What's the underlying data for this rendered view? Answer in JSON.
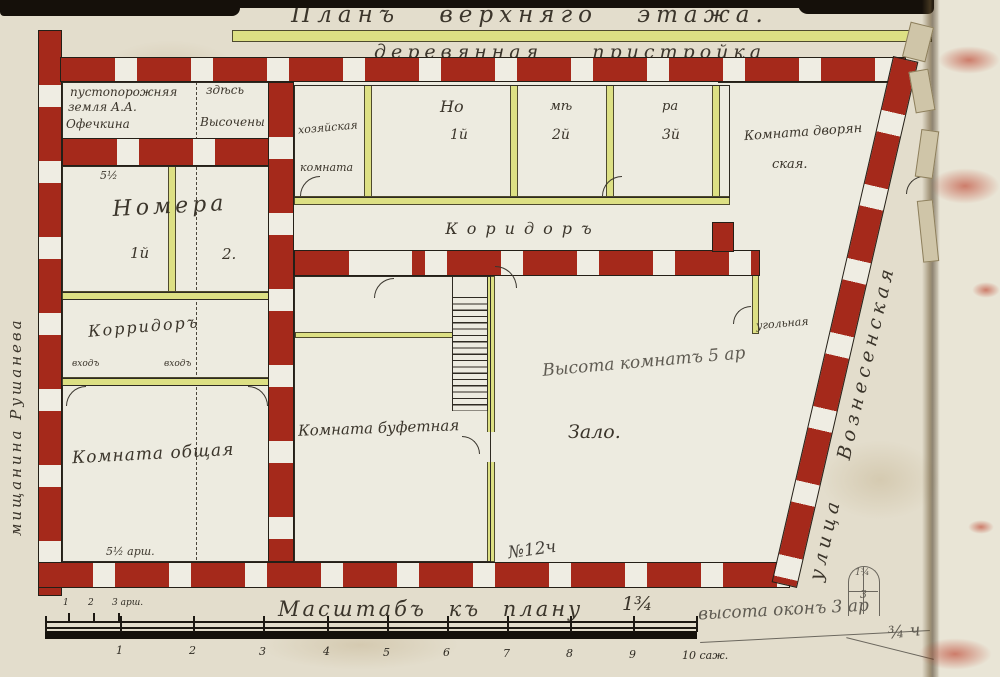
{
  "title": {
    "main": "Планъ  верхняго  этажа.",
    "sub": "деревянная  пристройка"
  },
  "margins": {
    "left_vertical": "мищанина        Рушанева",
    "right_vertical": "улица   Вознесенская"
  },
  "left_block": {
    "vacant": {
      "l1": "пустопорожняя",
      "l2": "здѣсь",
      "l3": "земля А.А.",
      "l4": "Офечкина",
      "l5": "Высочены"
    },
    "numera": {
      "dim": "5½",
      "name": "Номера",
      "n1": "1й",
      "n2": "2."
    },
    "corridor": {
      "name": "Корридоръ",
      "door1": "входъ",
      "door2": "входъ"
    },
    "common": {
      "name": "Комната общая"
    },
    "dim_bottom": "5½ арш."
  },
  "annex": {
    "khoz": {
      "l1": "хозяйская",
      "l2": "комната"
    },
    "no1": {
      "syl": "Но",
      "num": "1й"
    },
    "no2": {
      "syl": "мѣ",
      "num": "2й"
    },
    "no3": {
      "syl": "ра",
      "num": "3й"
    },
    "noble": {
      "l1": "Комната дворян",
      "l2": "ская."
    }
  },
  "main_rooms": {
    "corridor": "Коридоръ",
    "buffet": "Комната буфетная",
    "hall": "Зало.",
    "hall_pencil": "Высота комнатъ 5 ар",
    "corner": "угольная",
    "pencil_note": "№12ч"
  },
  "scale": {
    "title": "Масштабъ къ плану",
    "ratio": "1¾",
    "pencil_note": "высота оконъ 3 ар",
    "arshins": [
      "1",
      "2",
      "3 арш."
    ],
    "sazhens": [
      "1",
      "2",
      "3",
      "4",
      "5",
      "6",
      "7",
      "8",
      "9"
    ],
    "sazhen_last": "10 саж.",
    "fraction": "¾ ч"
  },
  "window_sketch": {
    "top": "1¾",
    "mid": "3"
  },
  "colors": {
    "wall_red": "#a5291b",
    "partition_yellow": "#dde084",
    "paper": "#e3ddcc",
    "interior": "#edebe0",
    "ink": "#2e2a22",
    "pencil": "#5f5b52"
  }
}
